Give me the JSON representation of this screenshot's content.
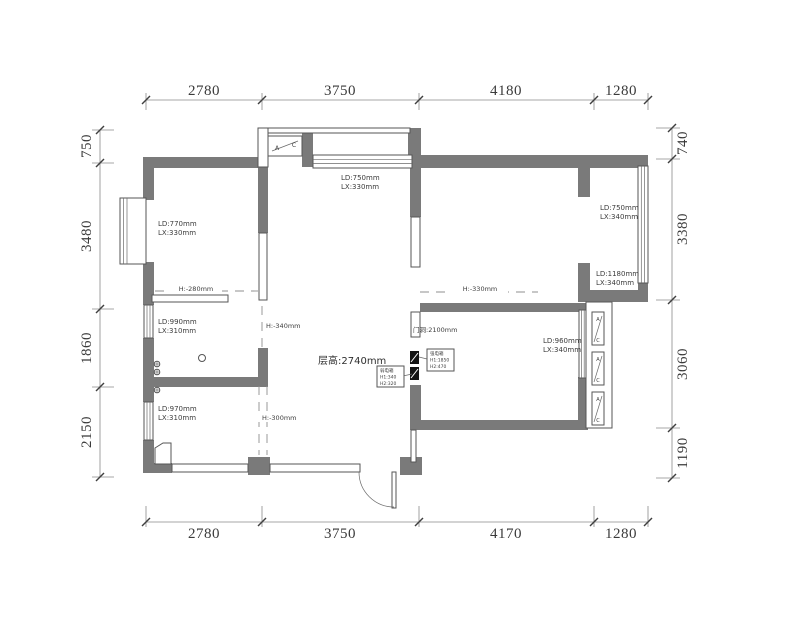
{
  "dims": {
    "top": [
      "2780",
      "3750",
      "4180",
      "1280"
    ],
    "bottom": [
      "2780",
      "3750",
      "4170",
      "1280"
    ],
    "left": [
      "750",
      "3480",
      "1860",
      "2150"
    ],
    "right": [
      "740",
      "3380",
      "3060",
      "1190"
    ]
  },
  "rooms": {
    "top_left": {
      "ld": "LD:770mm",
      "lx": "LX:330mm"
    },
    "balcony": {
      "ld": "LD:750mm",
      "lx": "LX:330mm"
    },
    "kitchen": {
      "ld": "LD:990mm",
      "lx": "LX:310mm"
    },
    "bath": {
      "ld": "LD:970mm",
      "lx": "LX:310mm"
    },
    "right_upper": {
      "ld": "LD:750mm",
      "lx": "LX:340mm"
    },
    "right_lower": {
      "ld": "LD:1180mm",
      "lx": "LX:340mm"
    },
    "bedroom": {
      "ld": "LD:960mm",
      "lx": "LX:340mm"
    }
  },
  "heights": {
    "ceiling": "层高:2740mm",
    "door_opening": "门洞:2100mm",
    "h280": "H:-280mm",
    "h340": "H:-340mm",
    "h300": "H:-300mm",
    "h330": "H:-330mm"
  },
  "callouts": {
    "strong_box": {
      "line1": "强电箱",
      "line2": "H1:1850",
      "line3": "H2:470"
    },
    "weak_box": {
      "line1": "弱电箱",
      "line2": "H1:340",
      "line3": "H2:320"
    }
  },
  "ac": {
    "a": "A",
    "c": "C"
  },
  "colors": {
    "wall": "#7a7a7a",
    "line": "#565656",
    "dim_text": "#3a3a3a",
    "background": "#ffffff"
  }
}
